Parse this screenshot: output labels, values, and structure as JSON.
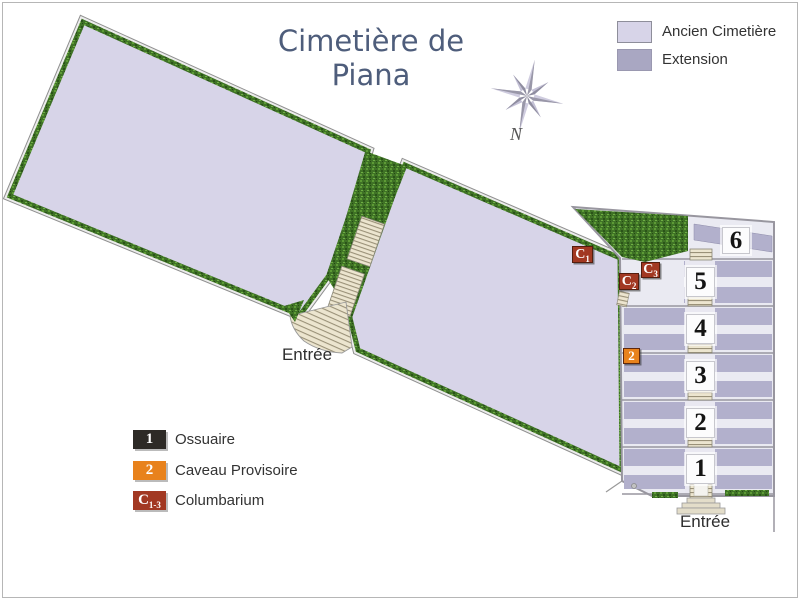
{
  "title": {
    "line1": "Cimetière de",
    "line2": "Piana"
  },
  "compass": {
    "north_label": "N"
  },
  "legend_area_types": {
    "items": [
      {
        "label": "Ancien Cimetière"
      },
      {
        "label": "Extension"
      }
    ]
  },
  "legend_markers": {
    "items": [
      {
        "symbol": "1",
        "label": "Ossuaire"
      },
      {
        "symbol": "2",
        "label": "Caveau Provisoire"
      },
      {
        "symbol": "C",
        "symbol_sub": "1-3",
        "label": "Columbarium"
      }
    ]
  },
  "map": {
    "entrance_old_label": "Entrée",
    "entrance_extension_label": "Entrée",
    "section_plates": [
      "6",
      "5",
      "4",
      "3",
      "2",
      "1"
    ],
    "markers": {
      "c1": {
        "main": "C",
        "sub": "1"
      },
      "c2": {
        "main": "C",
        "sub": "2"
      },
      "c3": {
        "main": "C",
        "sub": "3"
      },
      "caveau": {
        "main": "2"
      }
    }
  },
  "colors": {
    "ancien": "#d7d4e8",
    "extension_bg": "#eaeaf2",
    "extension_band": "#b2b0cc",
    "legend_extension_swatch": "#a9a7c2",
    "hedge": "#3f7226",
    "stairs": "#ece5cf",
    "wall": "#98969f",
    "title": "#4e5d7b",
    "text": "#333333",
    "marker_red": "#a23822",
    "marker_orange": "#e8821c",
    "marker_black": "#2d2a26"
  }
}
